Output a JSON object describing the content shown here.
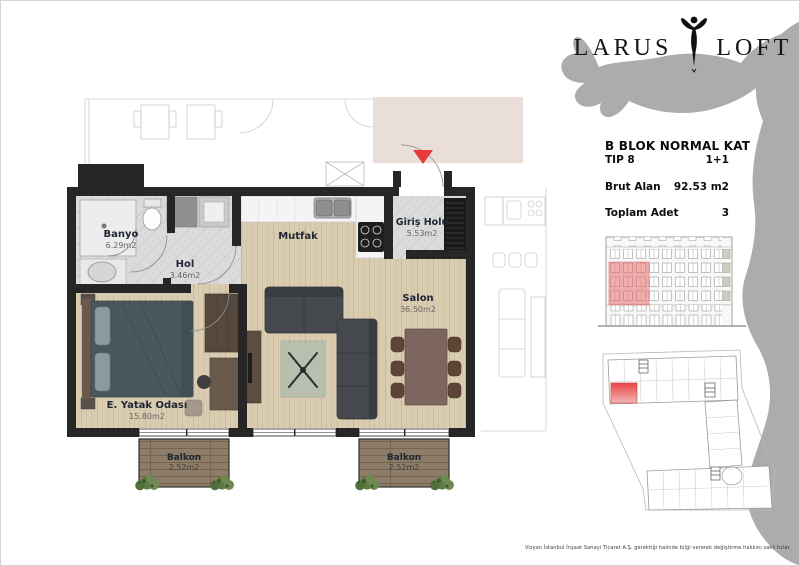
{
  "logo": {
    "word1": "LARUS",
    "word2": "LOFT"
  },
  "info": {
    "title": "B BLOK NORMAL KAT",
    "tip_label": "TIP 8",
    "tip_value": "1+1",
    "brut_label": "Brut Alan",
    "brut_value": "92.53 m2",
    "adet_label": "Toplam Adet",
    "adet_value": "3"
  },
  "plan": {
    "rooms": {
      "banyo": {
        "name": "Banyo",
        "area": "6.29m2"
      },
      "hol": {
        "name": "Hol",
        "area": "3.46m2"
      },
      "mutfak": {
        "name": "Mutfak",
        "area": ""
      },
      "giris_holu": {
        "name": "Giriş Holu",
        "area": "5.53m2"
      },
      "salon": {
        "name": "Salon",
        "area": "36.50m2"
      },
      "yatak": {
        "name": "E. Yatak Odası",
        "area": "15.80m2"
      },
      "balkon_left": {
        "name": "Balkon",
        "area": "2.52m2"
      },
      "balkon_right": {
        "name": "Balkon",
        "area": "2.52m2"
      }
    }
  },
  "colors": {
    "accent_red": "#e8393c",
    "silhouette_gray": "#acacac",
    "wall_black": "#262626",
    "wood": "#dacdb2",
    "tile": "#dbdbdb",
    "deck": "#8d7c67"
  },
  "disclaimer": "Vizyon İstanbul İnşaat Sanayi Ticaret A.Ş. gerektiği halinde bilgi vererek değiştirme hakkını saklı tutar."
}
